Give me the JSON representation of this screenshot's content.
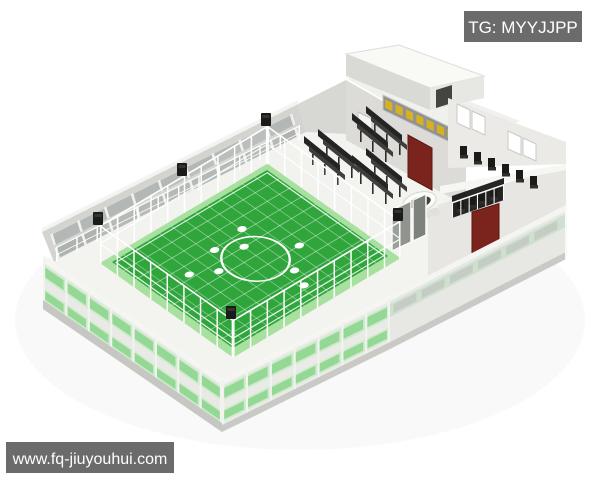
{
  "watermarks": {
    "telegram_badge": "TG: MYYJJPP",
    "website_badge": "www.fq-jiuyouhui.com"
  },
  "palette": {
    "badge_bg": "#6b6b6b",
    "badge_text": "#ffffff",
    "field_green": "#2fa53c",
    "apron_green": "#a8e0a0",
    "marking_white": "#ffffff",
    "door_red": "#7a241d",
    "sign_bg": "#909393",
    "sign_gold": "#d8b021",
    "glass_strip": "#cdeccd",
    "glass_pane": "#95d895",
    "wall_light": "#e9e9e5",
    "wall_shadow": "#d3d3cf",
    "roof_white": "#f9f9f6",
    "seat_black": "#232323"
  },
  "scene": {
    "subject": "3D isometric architectural render of an indoor five-a-side football field facility",
    "field": {
      "center_circle": true,
      "spot_count": 8,
      "overlay": "white grid lines"
    },
    "equipment": [
      "perimeter fence",
      "corner speaker boxes",
      "spectator bench rows",
      "clubhouse with gold signboard",
      "red doors",
      "oval tub",
      "green glass window strips"
    ]
  }
}
